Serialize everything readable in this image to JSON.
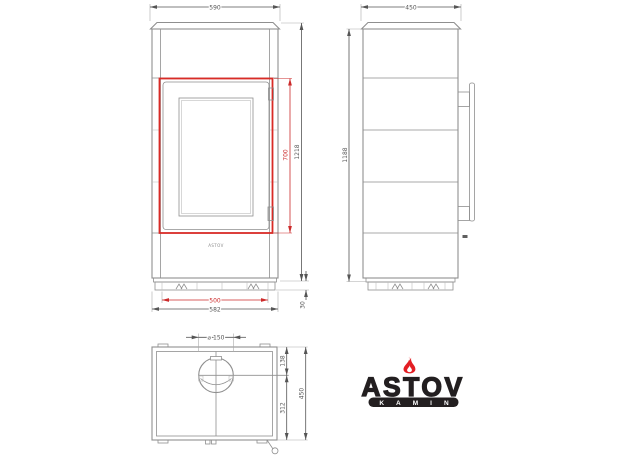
{
  "colors": {
    "line": "#8f8f8f",
    "dark": "#5f5f5f",
    "red": "#d92b26",
    "dimred": "#cc2a2a",
    "dimtext": "#555555",
    "logo_black": "#231f20",
    "logo_red": "#e31e24"
  },
  "front_view": {
    "top_width": "590",
    "door_height": "700",
    "total_height": "1218",
    "feet_span": "500",
    "base_width": "582",
    "base_height": "30",
    "brand_plate": "ASTOV"
  },
  "side_view": {
    "depth": "450",
    "body_height": "1188"
  },
  "top_view": {
    "flue_diameter": "⌀ 150",
    "back_to_flue_center": "138",
    "flue_center_to_front": "312",
    "depth": "450"
  },
  "logo": {
    "brand": "ASTOV",
    "subtitle": "KAMIN"
  }
}
